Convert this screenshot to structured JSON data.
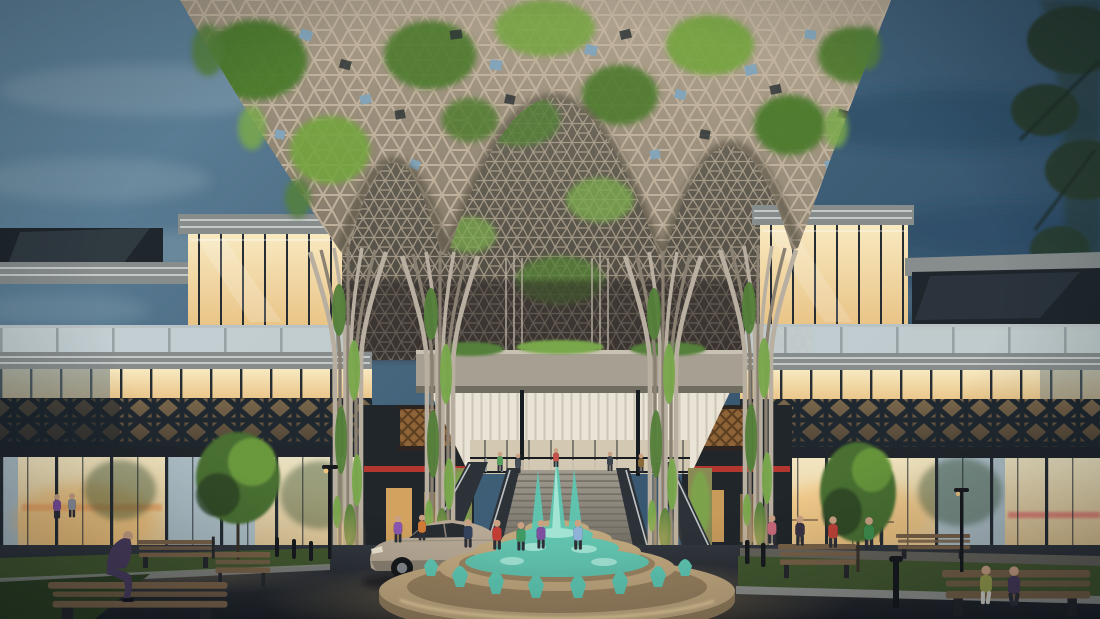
{
  "scene": {
    "title": "Dusk architectural rendering of a mall entrance plaza",
    "description": "Two symmetric glass building wings flank a towering parametric timber lattice canopy overgrown with greenery. A grand central staircase rises behind a round tiered fountain with teal cascading water. A silver coupe is parked left of the fountain; people stroll the plaza; benches, small trees and lawns line the foreground under a cloudy slate-blue evening sky.",
    "objects": [
      "evening sky with clouds",
      "parametric lattice canopy with moss and vines",
      "tree-shaped flaring columns covered in ivy",
      "left glass wing with rooftop penthouse",
      "right glass wing with rooftop penthouse",
      "glass balustrade terraces",
      "dark diamond-lattice facade bands",
      "warm-lit storefront glazing",
      "central concrete bridge with planters",
      "white slatted soffit ceiling",
      "grand staircase with escalators",
      "round tiered fountain with teal water jets",
      "silver coupe car",
      "pedestrians in colorful clothing",
      "man sitting on a bench",
      "wooden benches, bollards and lamp posts",
      "ornamental trees and lawn strips",
      "dark tree silhouette at right edge"
    ]
  },
  "colors": {
    "sky_top": "#688ca3",
    "sky_mid": "#47677f",
    "sky_deep": "#2e4c66",
    "cloud": "#a3b7c1",
    "cloud_dark": "#294660",
    "canopy_hi": "#b3a692",
    "canopy_lo": "#837867",
    "canopy_line": "#c3b5a0",
    "canopy_cell_dark": "#2f3738",
    "canopy_green": "#4c7a2d",
    "canopy_green_light": "#74a43f",
    "canopy_sky_gap": "#82a6bc",
    "vault_hi": "#7d7767",
    "vault_lo": "#45413a",
    "trunk": "#b8afa1",
    "trunk_shadow": "#8b8173",
    "ivy": "#55803a",
    "ivy_light": "#79a84c",
    "glass_cool": "#aebfc6",
    "glass_dark": "#1f262c",
    "mullion": "#262d33",
    "warm_hi": "#f8e9c0",
    "warm_lo": "#e9c385",
    "warm_glow": "#f3b968",
    "fascia": "#878d8d",
    "fascia_light": "#e2e6e1",
    "roofbox_dark": "#1f262c",
    "balustrade": "#ccd6d7",
    "balustrade_post": "#8e989b",
    "band_warm_top": "#7a674c",
    "band_warm_bot": "#4c4134",
    "band_x": "#20282f",
    "bronze": "#9a6a38",
    "bronze_dark": "#5d3f22",
    "storefront": "#20262a",
    "red_accent": "#c23b30",
    "ceiling": "#e9e4d5",
    "ceiling_slat": "#c9c3b2",
    "beam": "#a7a092",
    "beam_shadow": "#716c60",
    "landing_wall": "#d3c8b2",
    "stair_hi": "#a19b8f",
    "stair_lo": "#6b665d",
    "stair_wall": "#2c3238",
    "step_line": "#6f6b62",
    "fountain_stone": "#c0a77e",
    "fountain_stone_dark": "#937c5b",
    "water": "#5ec7b2",
    "water_light": "#aeeadb",
    "asphalt_hi": "#33373e",
    "asphalt_lo": "#1e2126",
    "pavement": "#56534e",
    "gravel": "#6e6960",
    "grass": "#44582f",
    "grass_dark": "#2f4023",
    "kerb": "#8f918c",
    "bench_wood": "#7a6248",
    "bench_frame": "#26282c",
    "car_body": "#b6a894",
    "car_body_dark": "#857b6b",
    "car_glass": "#272c31",
    "wheel": "#16181b",
    "rim": "#83878c",
    "tree_foliage": "#486f33",
    "tree_dark": "#2c4426",
    "tree_edge": "#2a3d2e",
    "lamp": "#17191d",
    "skin": "#caa183",
    "pants_dark": "#2e3038",
    "pants_light": "#d8d5cc",
    "glow_warm": "#f6c97e",
    "sunset_pink": "#e2766e",
    "sunset_orange": "#eda05f"
  },
  "people": [
    {
      "id": "sitting-man",
      "color": "#4a3c5e"
    },
    {
      "id": "plaza-left-purple",
      "color": "#8a56b0"
    },
    {
      "id": "plaza-left-orange",
      "color": "#d07a36"
    },
    {
      "id": "fountain-navy",
      "color": "#35425c"
    },
    {
      "id": "fountain-red",
      "color": "#c23d34"
    },
    {
      "id": "fountain-green",
      "color": "#3f9a63"
    },
    {
      "id": "fountain-purple",
      "color": "#7e4fa0"
    },
    {
      "id": "fountain-blue",
      "color": "#8fb2d8"
    },
    {
      "id": "right-pink",
      "color": "#c96a7a"
    },
    {
      "id": "right-dark",
      "color": "#3a3343"
    },
    {
      "id": "right-red",
      "color": "#bf4338"
    },
    {
      "id": "right-green",
      "color": "#3e8f4e"
    },
    {
      "id": "stairs-green",
      "color": "#57a05f"
    },
    {
      "id": "stairs-grey",
      "color": "#444c58"
    },
    {
      "id": "stairs-red",
      "color": "#c5524a"
    },
    {
      "id": "stairs-dark",
      "color": "#3c4450"
    },
    {
      "id": "stairs-tan",
      "color": "#8a6a3a"
    },
    {
      "id": "walk-woman-olive",
      "color": "#9aa04e"
    },
    {
      "id": "walk-man-purple",
      "color": "#4a3c5c"
    },
    {
      "id": "far-left-purple",
      "color": "#7a4f9e"
    },
    {
      "id": "far-left-grey",
      "color": "#8d939c"
    }
  ]
}
